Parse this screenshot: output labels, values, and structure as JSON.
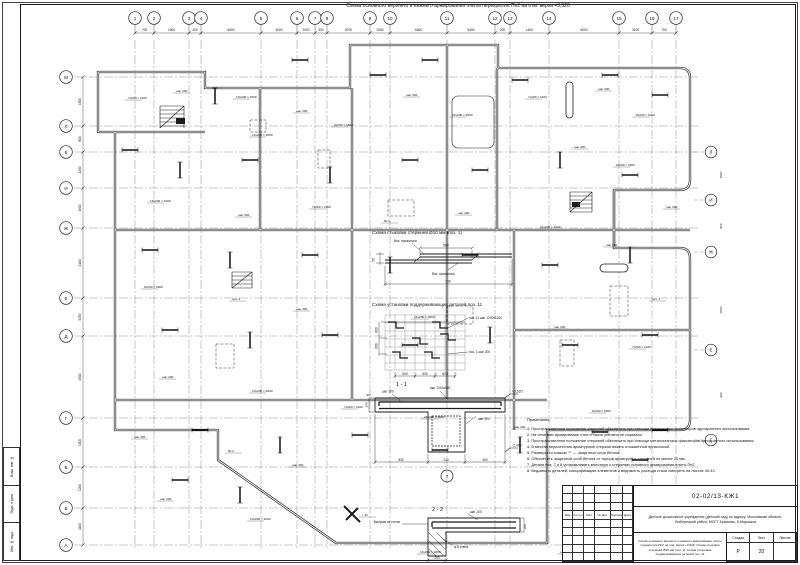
{
  "sheet": {
    "title": "Схема основного верхнего и нижнего армирования плиты перекрытия Пп2 на отм. верха +3,520",
    "stamps": [
      "Взам. инв. №",
      "Подп. и дата",
      "Инв. № подл."
    ]
  },
  "axes": {
    "top": [
      {
        "label": "1",
        "x": 135
      },
      {
        "label": "2",
        "x": 154
      },
      {
        "label": "3",
        "x": 189
      },
      {
        "label": "4",
        "x": 201
      },
      {
        "label": "5",
        "x": 261
      },
      {
        "label": "6",
        "x": 297
      },
      {
        "label": "7",
        "x": 315
      },
      {
        "label": "8",
        "x": 327
      },
      {
        "label": "9",
        "x": 370
      },
      {
        "label": "10",
        "x": 390
      },
      {
        "label": "11",
        "x": 447
      },
      {
        "label": "12",
        "x": 495
      },
      {
        "label": "13",
        "x": 510
      },
      {
        "label": "14",
        "x": 549
      },
      {
        "label": "15",
        "x": 619
      },
      {
        "label": "16",
        "x": 652
      },
      {
        "label": "17",
        "x": 676
      }
    ],
    "top_dims": [
      "700",
      "1900",
      "400",
      "6400",
      "4000",
      "2000",
      "300",
      "5700",
      "2050",
      "6400",
      "5450",
      "200",
      "1400",
      "6000",
      "3100",
      "700"
    ],
    "left": [
      {
        "label": "М",
        "y": 77
      },
      {
        "label": "Л",
        "y": 126
      },
      {
        "label": "К",
        "y": 152
      },
      {
        "label": "И",
        "y": 188
      },
      {
        "label": "Ж",
        "y": 228
      },
      {
        "label": "Е",
        "y": 298
      },
      {
        "label": "Д",
        "y": 336
      },
      {
        "label": "Г",
        "y": 418
      },
      {
        "label": "В",
        "y": 467
      },
      {
        "label": "Б",
        "y": 508
      },
      {
        "label": "А",
        "y": 545
      }
    ],
    "left_dims": [
      "1500",
      "800",
      "1200",
      "1500",
      "2100",
      "5250",
      "2500",
      "1500",
      "1200",
      "1100"
    ],
    "right": [
      {
        "label": "Л",
        "y": 152
      },
      {
        "label": "И",
        "y": 200
      },
      {
        "label": "Ж",
        "y": 252
      },
      {
        "label": "Е",
        "y": 350
      },
      {
        "label": "Г",
        "y": 440
      }
    ]
  },
  "plan": {
    "annotations": [
      {
        "x": 128,
        "y": 99,
        "t": "7x200 = 1400"
      },
      {
        "x": 176,
        "y": 92,
        "t": "шаг 200"
      },
      {
        "x": 236,
        "y": 98,
        "t": "10x200 = 2000"
      },
      {
        "x": 296,
        "y": 112,
        "t": "шаг 200"
      },
      {
        "x": 252,
        "y": 136,
        "t": "14x200 = 2800"
      },
      {
        "x": 334,
        "y": 126,
        "t": "9x200 = 1800"
      },
      {
        "x": 406,
        "y": 96,
        "t": "шаг 200"
      },
      {
        "x": 452,
        "y": 116,
        "t": "24x200 = 4800"
      },
      {
        "x": 528,
        "y": 98,
        "t": "7x200 = 1400"
      },
      {
        "x": 598,
        "y": 90,
        "t": "шаг 200"
      },
      {
        "x": 636,
        "y": 116,
        "t": "5x200 = 1000"
      },
      {
        "x": 574,
        "y": 148,
        "t": "шаг 200"
      },
      {
        "x": 616,
        "y": 166,
        "t": "9x200 = 1800"
      },
      {
        "x": 150,
        "y": 202,
        "t": "16x200 = 3200"
      },
      {
        "x": 238,
        "y": 216,
        "t": "шаг 200"
      },
      {
        "x": 312,
        "y": 208,
        "t": "7x200 = 1400"
      },
      {
        "x": 384,
        "y": 222,
        "t": "№ 1"
      },
      {
        "x": 458,
        "y": 214,
        "t": "шаг 200"
      },
      {
        "x": 540,
        "y": 228,
        "t": "21x200 = 4200"
      },
      {
        "x": 606,
        "y": 246,
        "t": "шаг 200"
      },
      {
        "x": 144,
        "y": 288,
        "t": "9x200 = 1800"
      },
      {
        "x": 232,
        "y": 300,
        "t": "поз. 2"
      },
      {
        "x": 296,
        "y": 310,
        "t": "шаг 200"
      },
      {
        "x": 414,
        "y": 318,
        "t": "14x200 = 2800"
      },
      {
        "x": 554,
        "y": 328,
        "t": "шаг 200"
      },
      {
        "x": 632,
        "y": 348,
        "t": "7x200 = 1400"
      },
      {
        "x": 162,
        "y": 378,
        "t": "шаг 200"
      },
      {
        "x": 252,
        "y": 392,
        "t": "10x200 = 2000"
      },
      {
        "x": 344,
        "y": 408,
        "t": "7x200 = 1400"
      },
      {
        "x": 424,
        "y": 418,
        "t": "24x200 = 5800"
      },
      {
        "x": 514,
        "y": 428,
        "t": "шаг 200"
      },
      {
        "x": 592,
        "y": 412,
        "t": "9x200 = 1800"
      },
      {
        "x": 134,
        "y": 438,
        "t": "шаг 200"
      },
      {
        "x": 228,
        "y": 452,
        "t": "№ 2"
      },
      {
        "x": 292,
        "y": 466,
        "t": "шаг 200"
      },
      {
        "x": 652,
        "y": 300,
        "t": "поз. 1"
      },
      {
        "x": 666,
        "y": 208,
        "t": "шаг 200"
      },
      {
        "x": 362,
        "y": 516,
        "t": "т 32"
      },
      {
        "x": 160,
        "y": 500,
        "t": "шаг 200"
      },
      {
        "x": 250,
        "y": 520,
        "t": "10x200 = 2000"
      },
      {
        "x": 420,
        "y": 553,
        "t": "14x200 = 2800"
      },
      {
        "x": 560,
        "y": 553,
        "t": "шаг 200"
      },
      {
        "x": 722,
        "y": 175,
        "t": "1500",
        "r": 1
      },
      {
        "x": 722,
        "y": 226,
        "t": "800",
        "r": 1
      },
      {
        "x": 722,
        "y": 310,
        "t": "1500",
        "r": 1
      },
      {
        "x": 722,
        "y": 395,
        "t": "900",
        "r": 1
      }
    ]
  },
  "splice_scheme": {
    "title": "Схема стыковки стержней Ø10 мм (поз. 1)",
    "wire1": "Вяз. проволока",
    "wire2": "Вяз. проволока",
    "dim_lap": "500",
    "dim_total": "730",
    "dim_h": "50"
  },
  "support_scheme": {
    "title": "Схема установки поддерживающих деталей поз. 11",
    "label_pos": "поз. 11 шаг 1200х1200",
    "label_step": "поз. 1 шаг 200",
    "dims_x": [
      "600",
      "600",
      "600"
    ],
    "dims_y": [
      "600",
      "600"
    ]
  },
  "sections": {
    "s11": {
      "title": "1 - 1",
      "axis": "7",
      "label1": "шаг 200",
      "label2": "шаг 1000х500",
      "label3": "шаг 200",
      "elev_top": "+3,520",
      "elev_bot": "-2,400",
      "dims_bottom": [
        "530",
        "240",
        "400"
      ],
      "dim_left": "200",
      "dim_star": "30*"
    },
    "s22": {
      "title": "2 - 2",
      "label1": "шаг 200",
      "wall": "ж.б стена",
      "left": "Выпуски из стены",
      "dim_b": "200",
      "dim_r": "200"
    }
  },
  "notes": {
    "heading": "Примечания",
    "items": [
      "1. Пространственное положение стержней обеспечить при помощи пластиковых фиксаторов однократного использования.",
      "2. На сечениях армирование стен и балок условно не показано.",
      "3. Пространственное положение стержней обеспечить при помощи металлических фиксаторов однократного использования.",
      "4. В местах пересечения арматурные стержни вязать отожжённой проволокой.",
      "5. Размеры со знаком \"*\" — защитные слои бетона.",
      "6. Обеспечить защитный слой бетона от торцов арматурных стержней не менее 20 мм.",
      "7. Детали поз. 7 и 8 устанавливать вплотную к стержням основного армирования плиты Пп2.",
      "8. Ведомость деталей, спецификацию элементов и ведомость расхода стали смотреть на листах 40-42."
    ]
  },
  "titleblock": {
    "doc_number": "02-02/13-КЖ1",
    "project": "Детское дошкольное учреждение (детский сад) по адресу: Московская область, Люберецкий район, МОГТ Красково, 8 Маршала",
    "drawing": "Схема основного верхнего и нижнего армирования плиты перекрытия Пп2 на отм. верха +3,520. Схема стыковки стержней Ø10 мм (поз. 1). Схема установки поддерживающих деталей поз. 11",
    "cols": [
      "Изм",
      "Кол.уч",
      "Лист",
      "№ Док.",
      "Подпись",
      "Дата"
    ],
    "stage_label": "Стадия",
    "sheet_label": "Лист",
    "sheets_label": "Листов",
    "stage": "Р",
    "sheet": "20",
    "sheets": ""
  }
}
